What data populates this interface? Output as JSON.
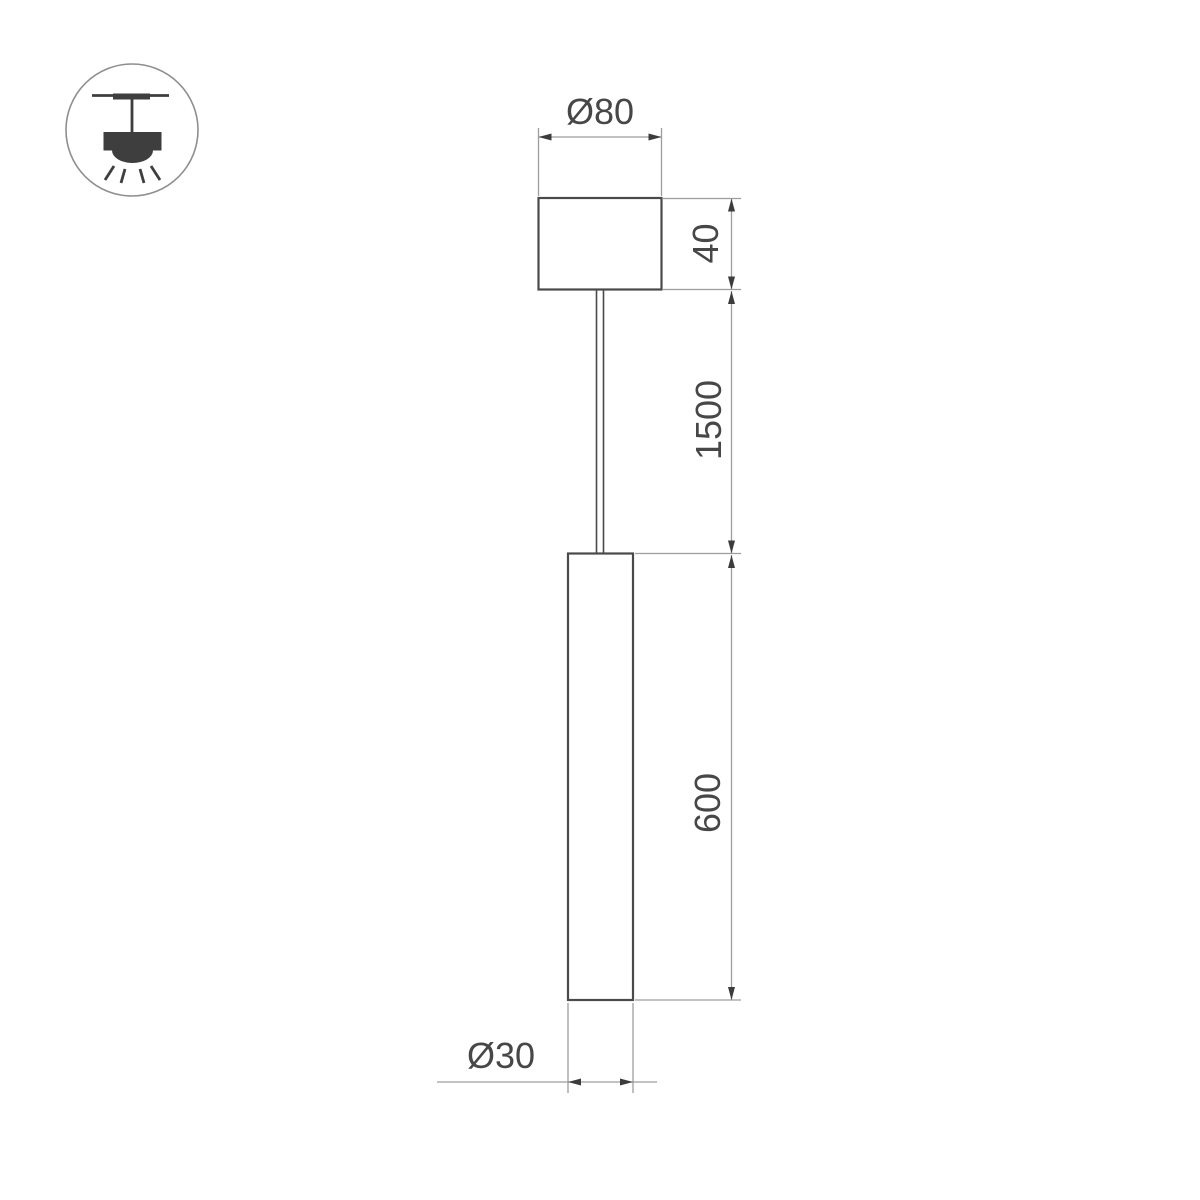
{
  "drawing": {
    "kind": "pendant-luminaire-dimension-drawing",
    "labels": {
      "canopy_diameter": "Ø80",
      "canopy_height": "40",
      "suspension_length": "1500",
      "tube_length": "600",
      "tube_diameter": "Ø30"
    },
    "icon": {
      "name": "ceiling-pendant-light"
    },
    "colors": {
      "background": "#ffffff",
      "object_line": "#4a4a4a",
      "dimension_line": "#9d9d9d",
      "arrowhead": "#3c3c3c",
      "label_text": "#474747",
      "icon_ink": "#3e3e3e",
      "icon_circle": "#8f8f8f"
    }
  }
}
